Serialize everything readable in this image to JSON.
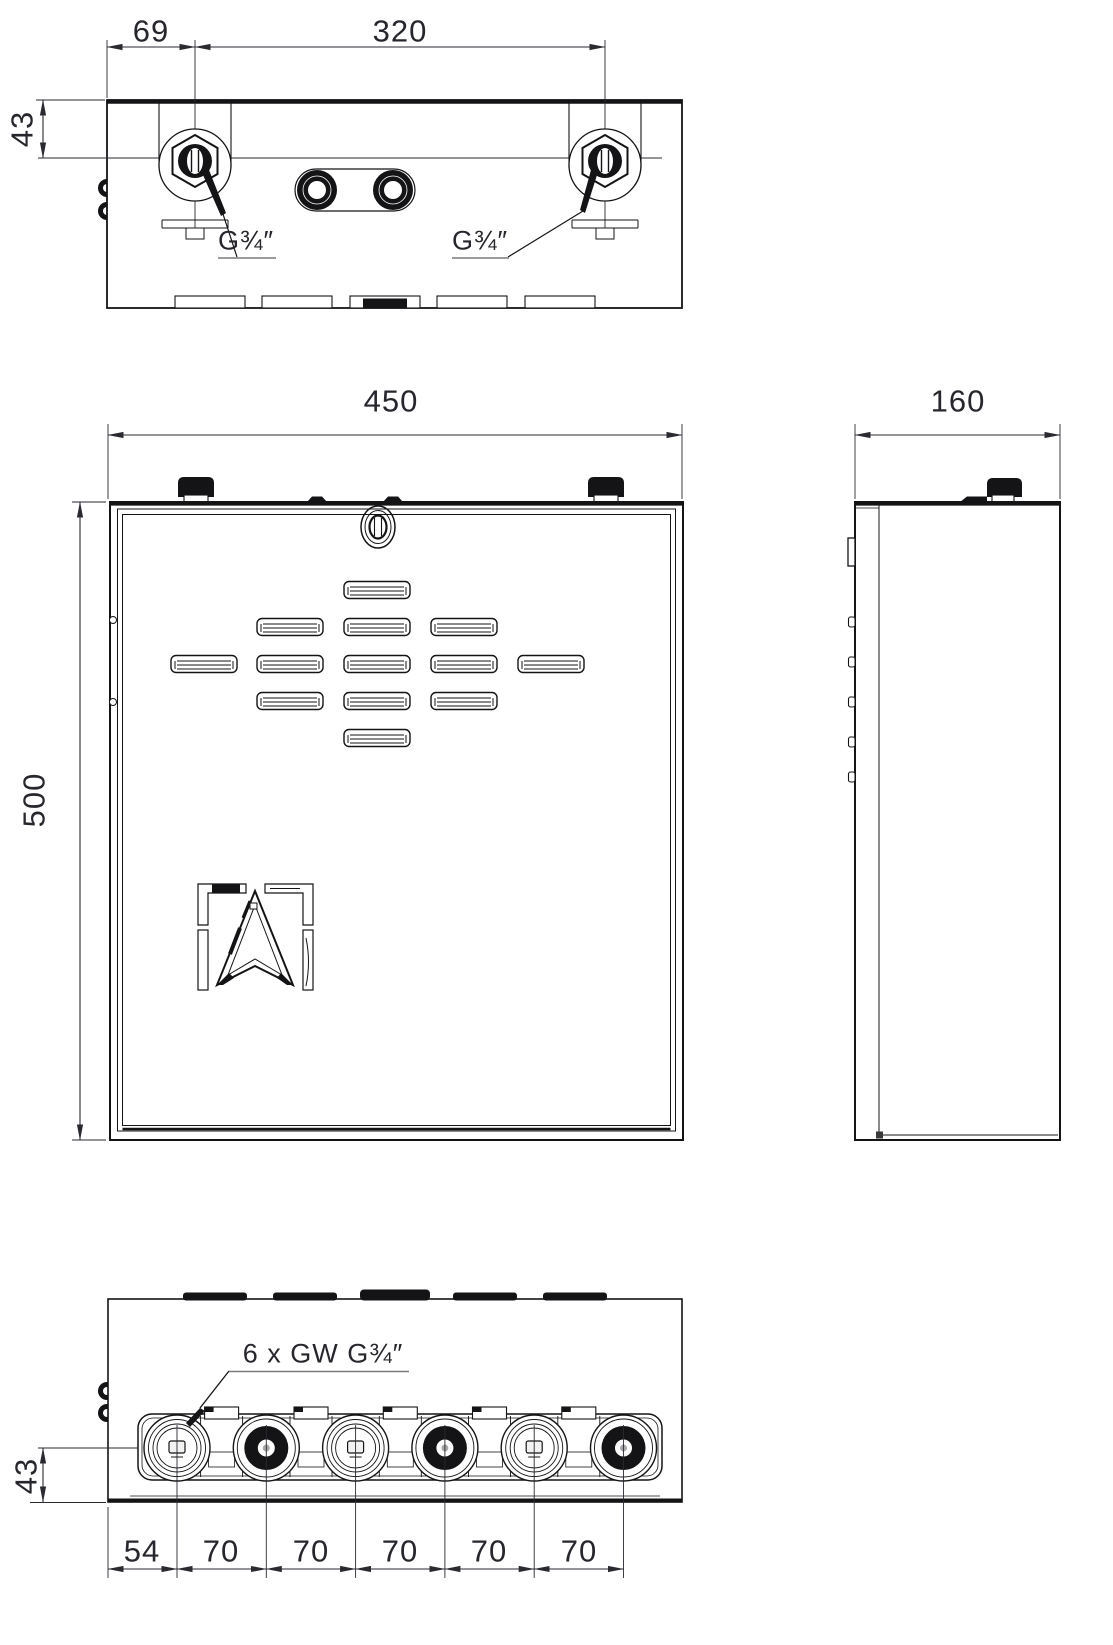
{
  "drawing": {
    "top_view": {
      "offset": "69",
      "spacing": "320",
      "depth": "43",
      "port_left": "G¾″",
      "port_right": "G¾″"
    },
    "front_view": {
      "width": "450",
      "height": "500"
    },
    "side_view": {
      "depth": "160"
    },
    "bottom_view": {
      "label": "6 x GW G¾″",
      "height": "43",
      "pitch": [
        "54",
        "70",
        "70",
        "70",
        "70",
        "70"
      ]
    },
    "colors": {
      "line": "#141416",
      "text": "#26262c"
    }
  }
}
